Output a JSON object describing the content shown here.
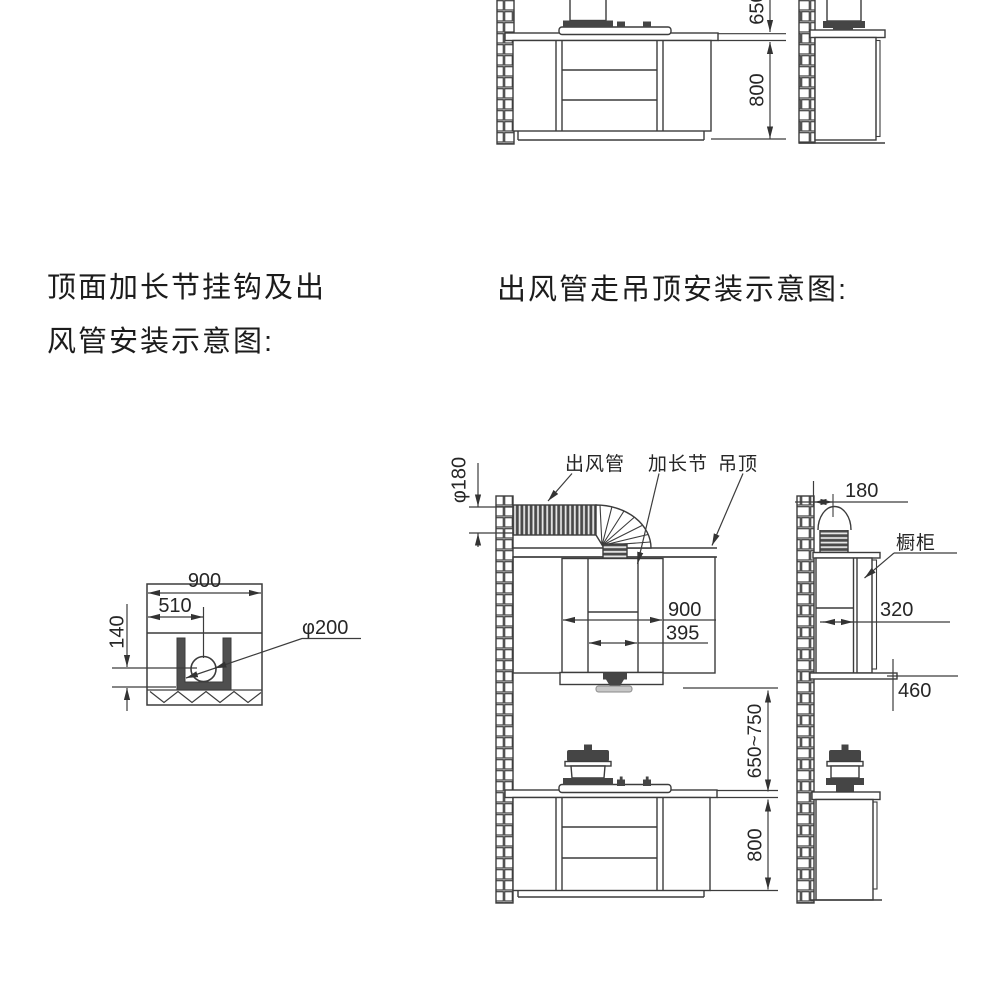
{
  "titles": {
    "left_line1": "顶面加长节挂钩及出",
    "left_line2": "风管安装示意图:",
    "right": "出风管走吊顶安装示意图:"
  },
  "top_partial_diagram": {
    "dim_hood_height": "650",
    "dim_counter_height": "800"
  },
  "hood_top_view": {
    "dim_width": "900",
    "dim_hole_offset": "510",
    "dim_hole_depth": "140",
    "dim_hole_diameter": "φ200"
  },
  "ceiling_install_view": {
    "label_outlet_pipe": "出风管",
    "label_extension_section": "加长节",
    "label_ceiling": "吊顶",
    "label_cabinet": "橱柜",
    "dim_duct_diameter": "φ180",
    "dim_wall_offset": "180",
    "dim_hood_width": "900",
    "dim_outlet_width": "395",
    "dim_cabinet_depth": "320",
    "dim_cabinet_height": "460",
    "dim_hood_to_counter": "650~750",
    "dim_counter_height": "800"
  },
  "colors": {
    "line": "#3c3c3c",
    "dark_fill": "#4a4a4a",
    "tray_fill": "#c8c8c8",
    "background": "#ffffff"
  }
}
